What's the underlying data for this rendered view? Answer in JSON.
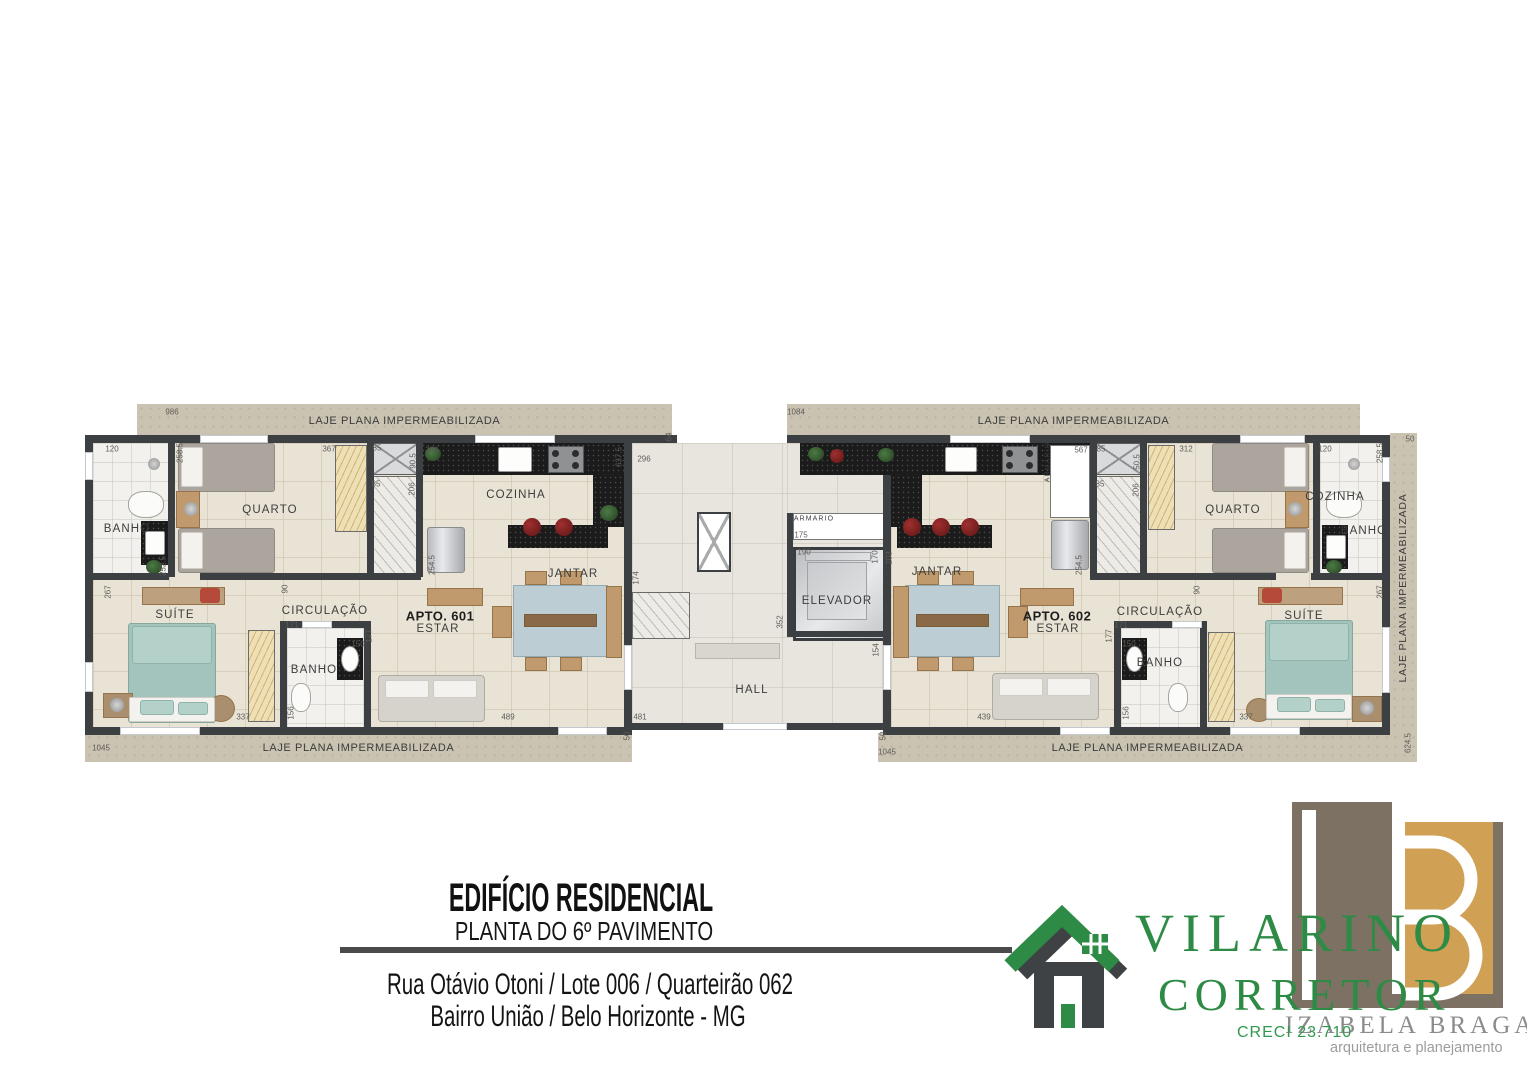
{
  "title_block": {
    "title": "EDIFÍCIO RESIDENCIAL",
    "subtitle": "PLANTA DO 6º PAVIMENTO",
    "address_line1": "Rua Otávio Otoni / Lote 006 / Quarteirão 062",
    "address_line2": "Bairro União / Belo Horizonte - MG"
  },
  "branding": {
    "broker": {
      "name": "VILARINO",
      "title": "CORRETOR",
      "creci": "CRECI 23.710",
      "color": "#2e8b45"
    },
    "architect": {
      "name": "IZABELA BRAGA",
      "tagline": "arquitetura e planejamento",
      "colors": {
        "taupe": "#7d7164",
        "tan": "#d0a055"
      }
    }
  },
  "plan": {
    "laje_label": "LAJE PLANA IMPERMEABILIZADA",
    "colors": {
      "wall": "#3d4043",
      "floor": "#e9e3d5",
      "bath_floor": "#f2f1ed",
      "hall_floor": "#e8e5df",
      "counter": "#1b1b1b",
      "laje": "#cac3b2",
      "suite_bed": "#a3c4bc"
    },
    "room_labels": [
      {
        "t": "BANHO",
        "x": 127,
        "y": 529
      },
      {
        "t": "QUARTO",
        "x": 270,
        "y": 510
      },
      {
        "t": "COZINHA",
        "x": 516,
        "y": 495
      },
      {
        "t": "JANTAR",
        "x": 573,
        "y": 574
      },
      {
        "t": "SUÍTE",
        "x": 175,
        "y": 615
      },
      {
        "t": "CIRCULAÇÃO",
        "x": 325,
        "y": 611
      },
      {
        "t": "APTO. 601",
        "x": 440,
        "y": 616,
        "b": 1
      },
      {
        "t": "ESTAR",
        "x": 438,
        "y": 629
      },
      {
        "t": "BANHO",
        "x": 314,
        "y": 670
      },
      {
        "t": "HALL",
        "x": 752,
        "y": 690
      },
      {
        "t": "ELEVADOR",
        "x": 837,
        "y": 601
      },
      {
        "t": "ARMARIO",
        "x": 814,
        "y": 519,
        "s": 7
      },
      {
        "t": "ARMÁRIO",
        "x": 1048,
        "y": 462,
        "v": 1,
        "s": 7
      },
      {
        "t": "COZINHA",
        "x": 1335,
        "y": 497
      },
      {
        "t": "JANTAR",
        "x": 937,
        "y": 572
      },
      {
        "t": "QUARTO",
        "x": 1233,
        "y": 510
      },
      {
        "t": "BANHO",
        "x": 1364,
        "y": 531
      },
      {
        "t": "SUÍTE",
        "x": 1304,
        "y": 616
      },
      {
        "t": "CIRCULAÇÃO",
        "x": 1160,
        "y": 612
      },
      {
        "t": "APTO. 602",
        "x": 1057,
        "y": 616,
        "b": 1
      },
      {
        "t": "ESTAR",
        "x": 1058,
        "y": 629
      },
      {
        "t": "BANHO",
        "x": 1160,
        "y": 663
      }
    ],
    "dimensions": [
      {
        "t": "986",
        "x": 172,
        "y": 412
      },
      {
        "t": "1084",
        "x": 796,
        "y": 412
      },
      {
        "t": "64",
        "x": 669,
        "y": 437,
        "v": 1
      },
      {
        "t": "50",
        "x": 1410,
        "y": 439
      },
      {
        "t": "120",
        "x": 112,
        "y": 449
      },
      {
        "t": "258.5",
        "x": 180,
        "y": 453,
        "v": 1
      },
      {
        "t": "367",
        "x": 329,
        "y": 449
      },
      {
        "t": "85",
        "x": 377,
        "y": 448
      },
      {
        "t": "90.5",
        "x": 413,
        "y": 461,
        "v": 1
      },
      {
        "t": "85",
        "x": 376,
        "y": 484
      },
      {
        "t": "206",
        "x": 412,
        "y": 489,
        "v": 1
      },
      {
        "t": "386",
        "x": 432,
        "y": 450
      },
      {
        "t": "637.5",
        "x": 619,
        "y": 457,
        "v": 1
      },
      {
        "t": "296",
        "x": 644,
        "y": 459
      },
      {
        "t": "567",
        "x": 1081,
        "y": 450
      },
      {
        "t": "85",
        "x": 1101,
        "y": 449
      },
      {
        "t": "50.5",
        "x": 1137,
        "y": 462,
        "v": 1
      },
      {
        "t": "85",
        "x": 1100,
        "y": 484
      },
      {
        "t": "206",
        "x": 1136,
        "y": 490,
        "v": 1
      },
      {
        "t": "312",
        "x": 1186,
        "y": 449
      },
      {
        "t": "120",
        "x": 1325,
        "y": 449
      },
      {
        "t": "258.5",
        "x": 1380,
        "y": 453,
        "v": 1
      },
      {
        "t": "175",
        "x": 801,
        "y": 535
      },
      {
        "t": "190",
        "x": 804,
        "y": 552
      },
      {
        "t": "170",
        "x": 875,
        "y": 557,
        "v": 1
      },
      {
        "t": "203",
        "x": 889,
        "y": 558,
        "v": 1
      },
      {
        "t": "154",
        "x": 876,
        "y": 650,
        "v": 1
      },
      {
        "t": "174",
        "x": 636,
        "y": 578,
        "v": 1
      },
      {
        "t": "352",
        "x": 780,
        "y": 622,
        "v": 1
      },
      {
        "t": "254.5",
        "x": 432,
        "y": 565,
        "v": 1
      },
      {
        "t": "254.5",
        "x": 1079,
        "y": 565,
        "v": 1
      },
      {
        "t": "252.5",
        "x": 163,
        "y": 566,
        "v": 1
      },
      {
        "t": "267",
        "x": 108,
        "y": 592,
        "v": 1
      },
      {
        "t": "267",
        "x": 1380,
        "y": 592,
        "v": 1
      },
      {
        "t": "90",
        "x": 285,
        "y": 589,
        "v": 1
      },
      {
        "t": "90",
        "x": 1197,
        "y": 590,
        "v": 1
      },
      {
        "t": "171",
        "x": 292,
        "y": 625
      },
      {
        "t": "177",
        "x": 369,
        "y": 636,
        "v": 1
      },
      {
        "t": "150",
        "x": 358,
        "y": 644
      },
      {
        "t": "156",
        "x": 291,
        "y": 713,
        "v": 1
      },
      {
        "t": "337",
        "x": 243,
        "y": 717
      },
      {
        "t": "489",
        "x": 508,
        "y": 717
      },
      {
        "t": "481",
        "x": 640,
        "y": 717
      },
      {
        "t": "439",
        "x": 984,
        "y": 717
      },
      {
        "t": "171",
        "x": 1121,
        "y": 625
      },
      {
        "t": "177",
        "x": 1109,
        "y": 636,
        "v": 1
      },
      {
        "t": "150",
        "x": 1129,
        "y": 644
      },
      {
        "t": "156",
        "x": 1126,
        "y": 713,
        "v": 1
      },
      {
        "t": "337",
        "x": 1246,
        "y": 717
      },
      {
        "t": "50",
        "x": 627,
        "y": 736,
        "v": 1
      },
      {
        "t": "50",
        "x": 883,
        "y": 736,
        "v": 1
      },
      {
        "t": "1045",
        "x": 101,
        "y": 748
      },
      {
        "t": "1045",
        "x": 887,
        "y": 752
      },
      {
        "t": "624.5",
        "x": 1408,
        "y": 743,
        "v": 1
      }
    ]
  }
}
